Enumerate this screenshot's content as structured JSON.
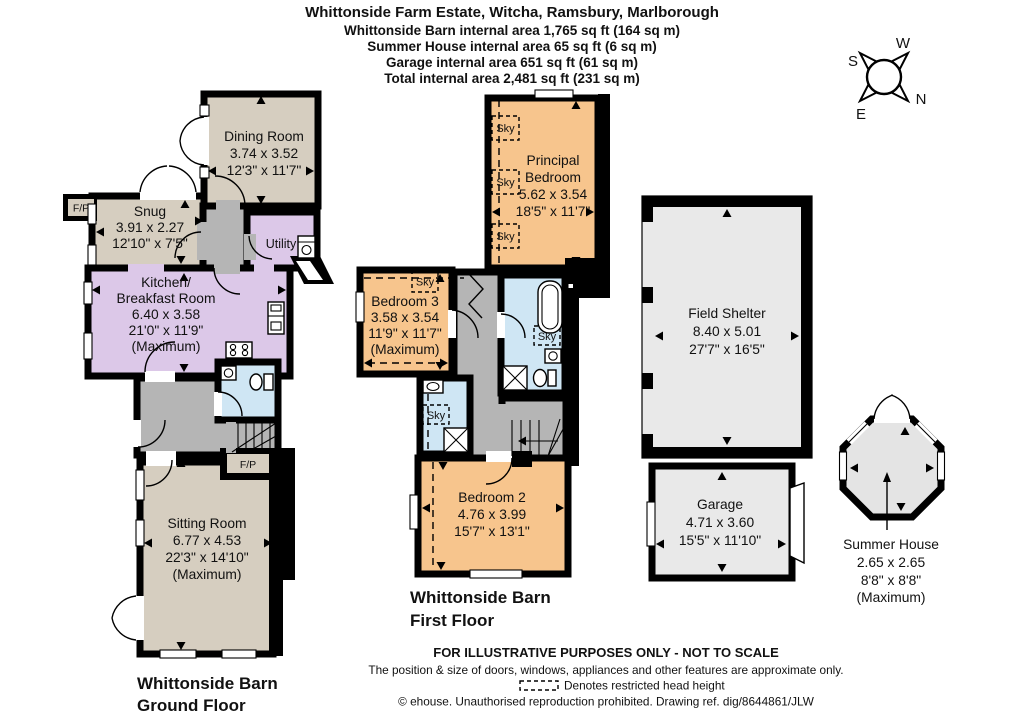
{
  "title": {
    "line1": "Whittonside Farm Estate, Witcha, Ramsbury, Marlborough",
    "line2": "Whittonside Barn  internal area 1,765 sq ft (164 sq m)",
    "line3": "Summer House internal area 65 sq ft (6 sq m)",
    "line4": "Garage internal area 651 sq ft (61 sq m)",
    "line5": "Total internal area 2,481 sq ft (231 sq m)"
  },
  "compass": {
    "n": "N",
    "s": "S",
    "e": "E",
    "w": "W"
  },
  "floors": {
    "ground": {
      "caption1": "Whittonside Barn",
      "caption2": "Ground Floor"
    },
    "first": {
      "caption1": "Whittonside Barn",
      "caption2": "First Floor"
    }
  },
  "rooms": {
    "dining": {
      "name": "Dining Room",
      "metric": "3.74 x 3.52",
      "imperial": "12'3\" x 11'7\""
    },
    "snug": {
      "name": "Snug",
      "metric": "3.91 x 2.27",
      "imperial": "12'10\" x 7'5\""
    },
    "utility": {
      "name": "Utility"
    },
    "kitchen": {
      "name1": "Kitchen/",
      "name2": "Breakfast Room",
      "metric": "6.40 x 3.58",
      "imperial": "21'0\" x 11'9\"",
      "note": "(Maximum)"
    },
    "sitting": {
      "name": "Sitting Room",
      "metric": "6.77 x 4.53",
      "imperial": "22'3\" x 14'10\"",
      "note": "(Maximum)"
    },
    "principal": {
      "name1": "Principal",
      "name2": "Bedroom",
      "metric": "5.62 x 3.54",
      "imperial": "18'5\" x 11'7\""
    },
    "bedroom3": {
      "name": "Bedroom 3",
      "metric": "3.58 x 3.54",
      "imperial": "11'9\" x 11'7\"",
      "note": "(Maximum)"
    },
    "bedroom2": {
      "name": "Bedroom 2",
      "metric": "4.76 x 3.99",
      "imperial": "15'7\" x 13'1\""
    },
    "field_shelter": {
      "name": "Field Shelter",
      "metric": "8.40 x 5.01",
      "imperial": "27'7\" x 16'5\""
    },
    "garage": {
      "name": "Garage",
      "metric": "4.71 x 3.60",
      "imperial": "15'5\" x 11'10\""
    },
    "summer_house": {
      "name": "Summer House",
      "metric": "2.65 x 2.65",
      "imperial": "8'8\" x 8'8\"",
      "note": "(Maximum)"
    }
  },
  "labels": {
    "fireplace": "F/P",
    "skylight": "Sky"
  },
  "footer": {
    "line1": "FOR ILLUSTRATIVE PURPOSES ONLY - NOT TO SCALE",
    "line2": "The position & size of doors, windows, appliances and other features are approximate only.",
    "line3": "Denotes restricted head height",
    "line4": "© ehouse. Unauthorised reproduction prohibited. Drawing ref. dig/8644861/JLW"
  },
  "colors": {
    "wall": "#000000",
    "reception": "#d6cec0",
    "kitchen": "#dcc8e8",
    "bedroom": "#f7c58d",
    "bathroom": "#cfe6f4",
    "hall": "#b5b5b5",
    "outbuilding": "#e9e9e9"
  }
}
